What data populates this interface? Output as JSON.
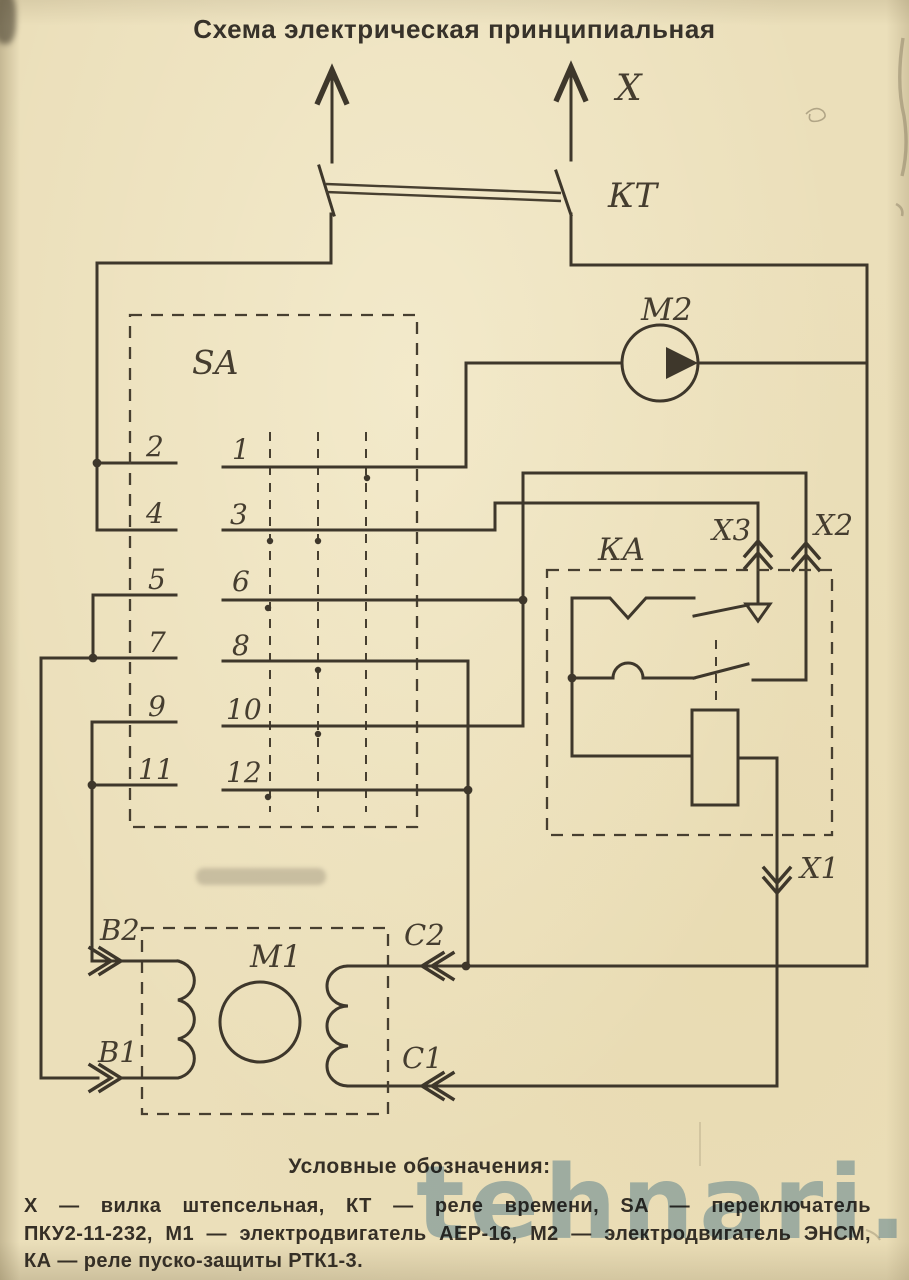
{
  "title": "Схема электрическая принципиальная",
  "schematic": {
    "plug_label": "Х",
    "time_relay_label": "КТ",
    "motor2_label": "М2",
    "switch_label": "SA",
    "protect_relay_label": "КА",
    "connector_x1": "Х1",
    "connector_x2": "Х2",
    "connector_x3": "Х3",
    "motor1_label": "М1",
    "terminal_b2": "В2",
    "terminal_b1": "В1",
    "terminal_c2": "С2",
    "terminal_c1": "С1",
    "sa_left_contacts": [
      "2",
      "4",
      "5",
      "7",
      "9",
      "11"
    ],
    "sa_right_contacts": [
      "1",
      "3",
      "6",
      "8",
      "10",
      "12"
    ]
  },
  "legend": {
    "heading": "Условные обозначения:",
    "lines": [
      "Х — вилка штепсельная, КТ — реле времени, SA — переключатель",
      "ПКУ2-11-232, М1 — электродвигатель АЕР-16, М2 — электродвигатель ЭНСМ,",
      "КА — реле пуско-защиты РТК1-3."
    ]
  },
  "watermark": "tehnari.ru",
  "colors": {
    "paper": "#ebdfba",
    "ink": "#3e372b",
    "watermark": "#5f93c4"
  }
}
